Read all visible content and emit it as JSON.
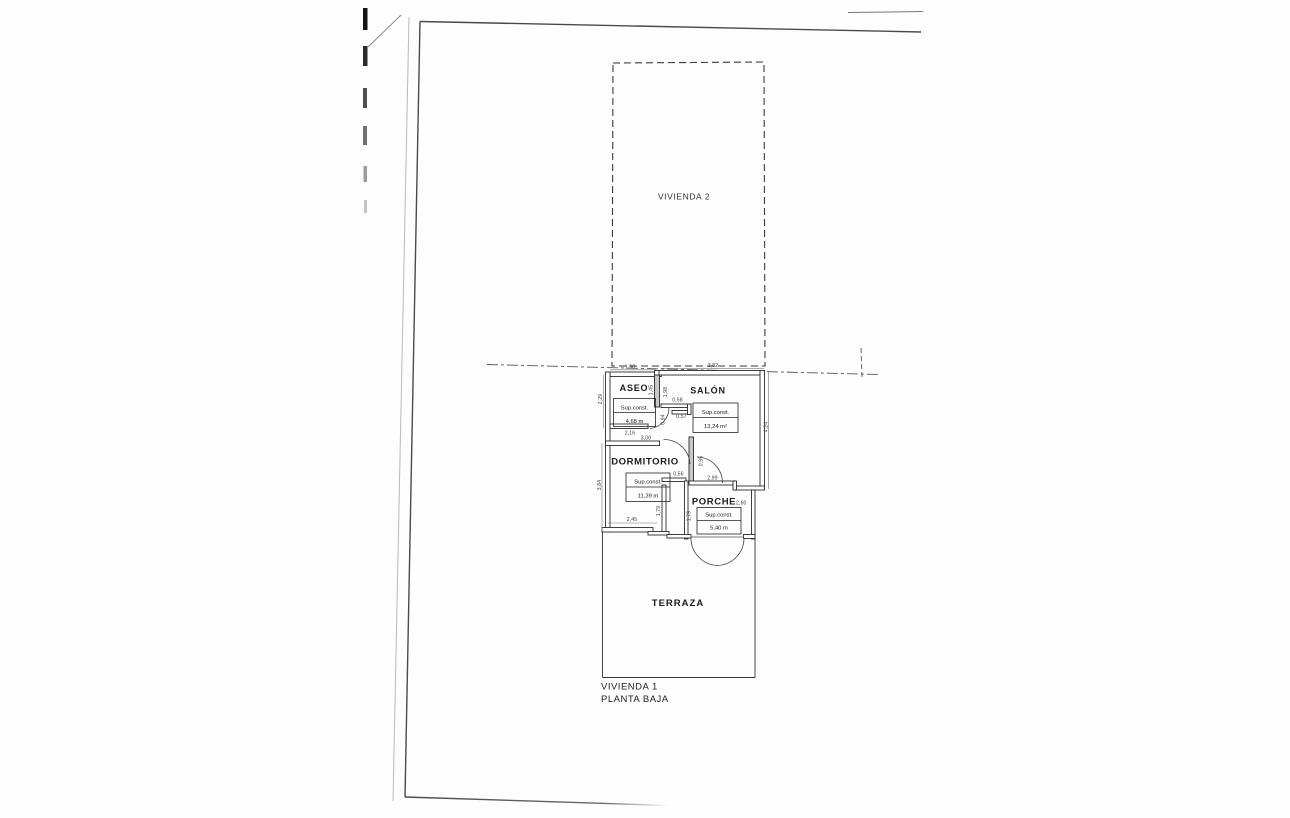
{
  "labels": {
    "vivienda2": "VIVIENDA 2",
    "vivienda1": "VIVIENDA 1",
    "planta_baja": "PLANTA BAJA"
  },
  "rooms": {
    "aseo": {
      "name": "ASEO",
      "sup": "Sup.const.",
      "area": "4,68 m"
    },
    "salon": {
      "name": "SALÓN",
      "sup": "Sup.const.",
      "area": "13,24 m²"
    },
    "dormitorio": {
      "name": "DORMITORIO",
      "sup": "Sup.const.",
      "area": "11,39 m"
    },
    "porche": {
      "name": "PORCHE",
      "sup": "Sup.const.",
      "area": "5,40 m",
      "width_dim": "2,60"
    },
    "terraza": {
      "name": "TERRAZA"
    }
  },
  "dims": [
    "1,98",
    "3,82",
    "2,29",
    "1,45",
    "1,98",
    "0,58",
    "0,57",
    "0,94",
    "2,16",
    "3,00",
    "4,24",
    "3,84",
    "0,56",
    "0,95",
    "2,99",
    "2,45",
    "1,79",
    "1,79"
  ],
  "colors": {
    "ink": "#2d2d2d",
    "faint": "#9a9a9a",
    "paper": "#fdfdfd"
  }
}
